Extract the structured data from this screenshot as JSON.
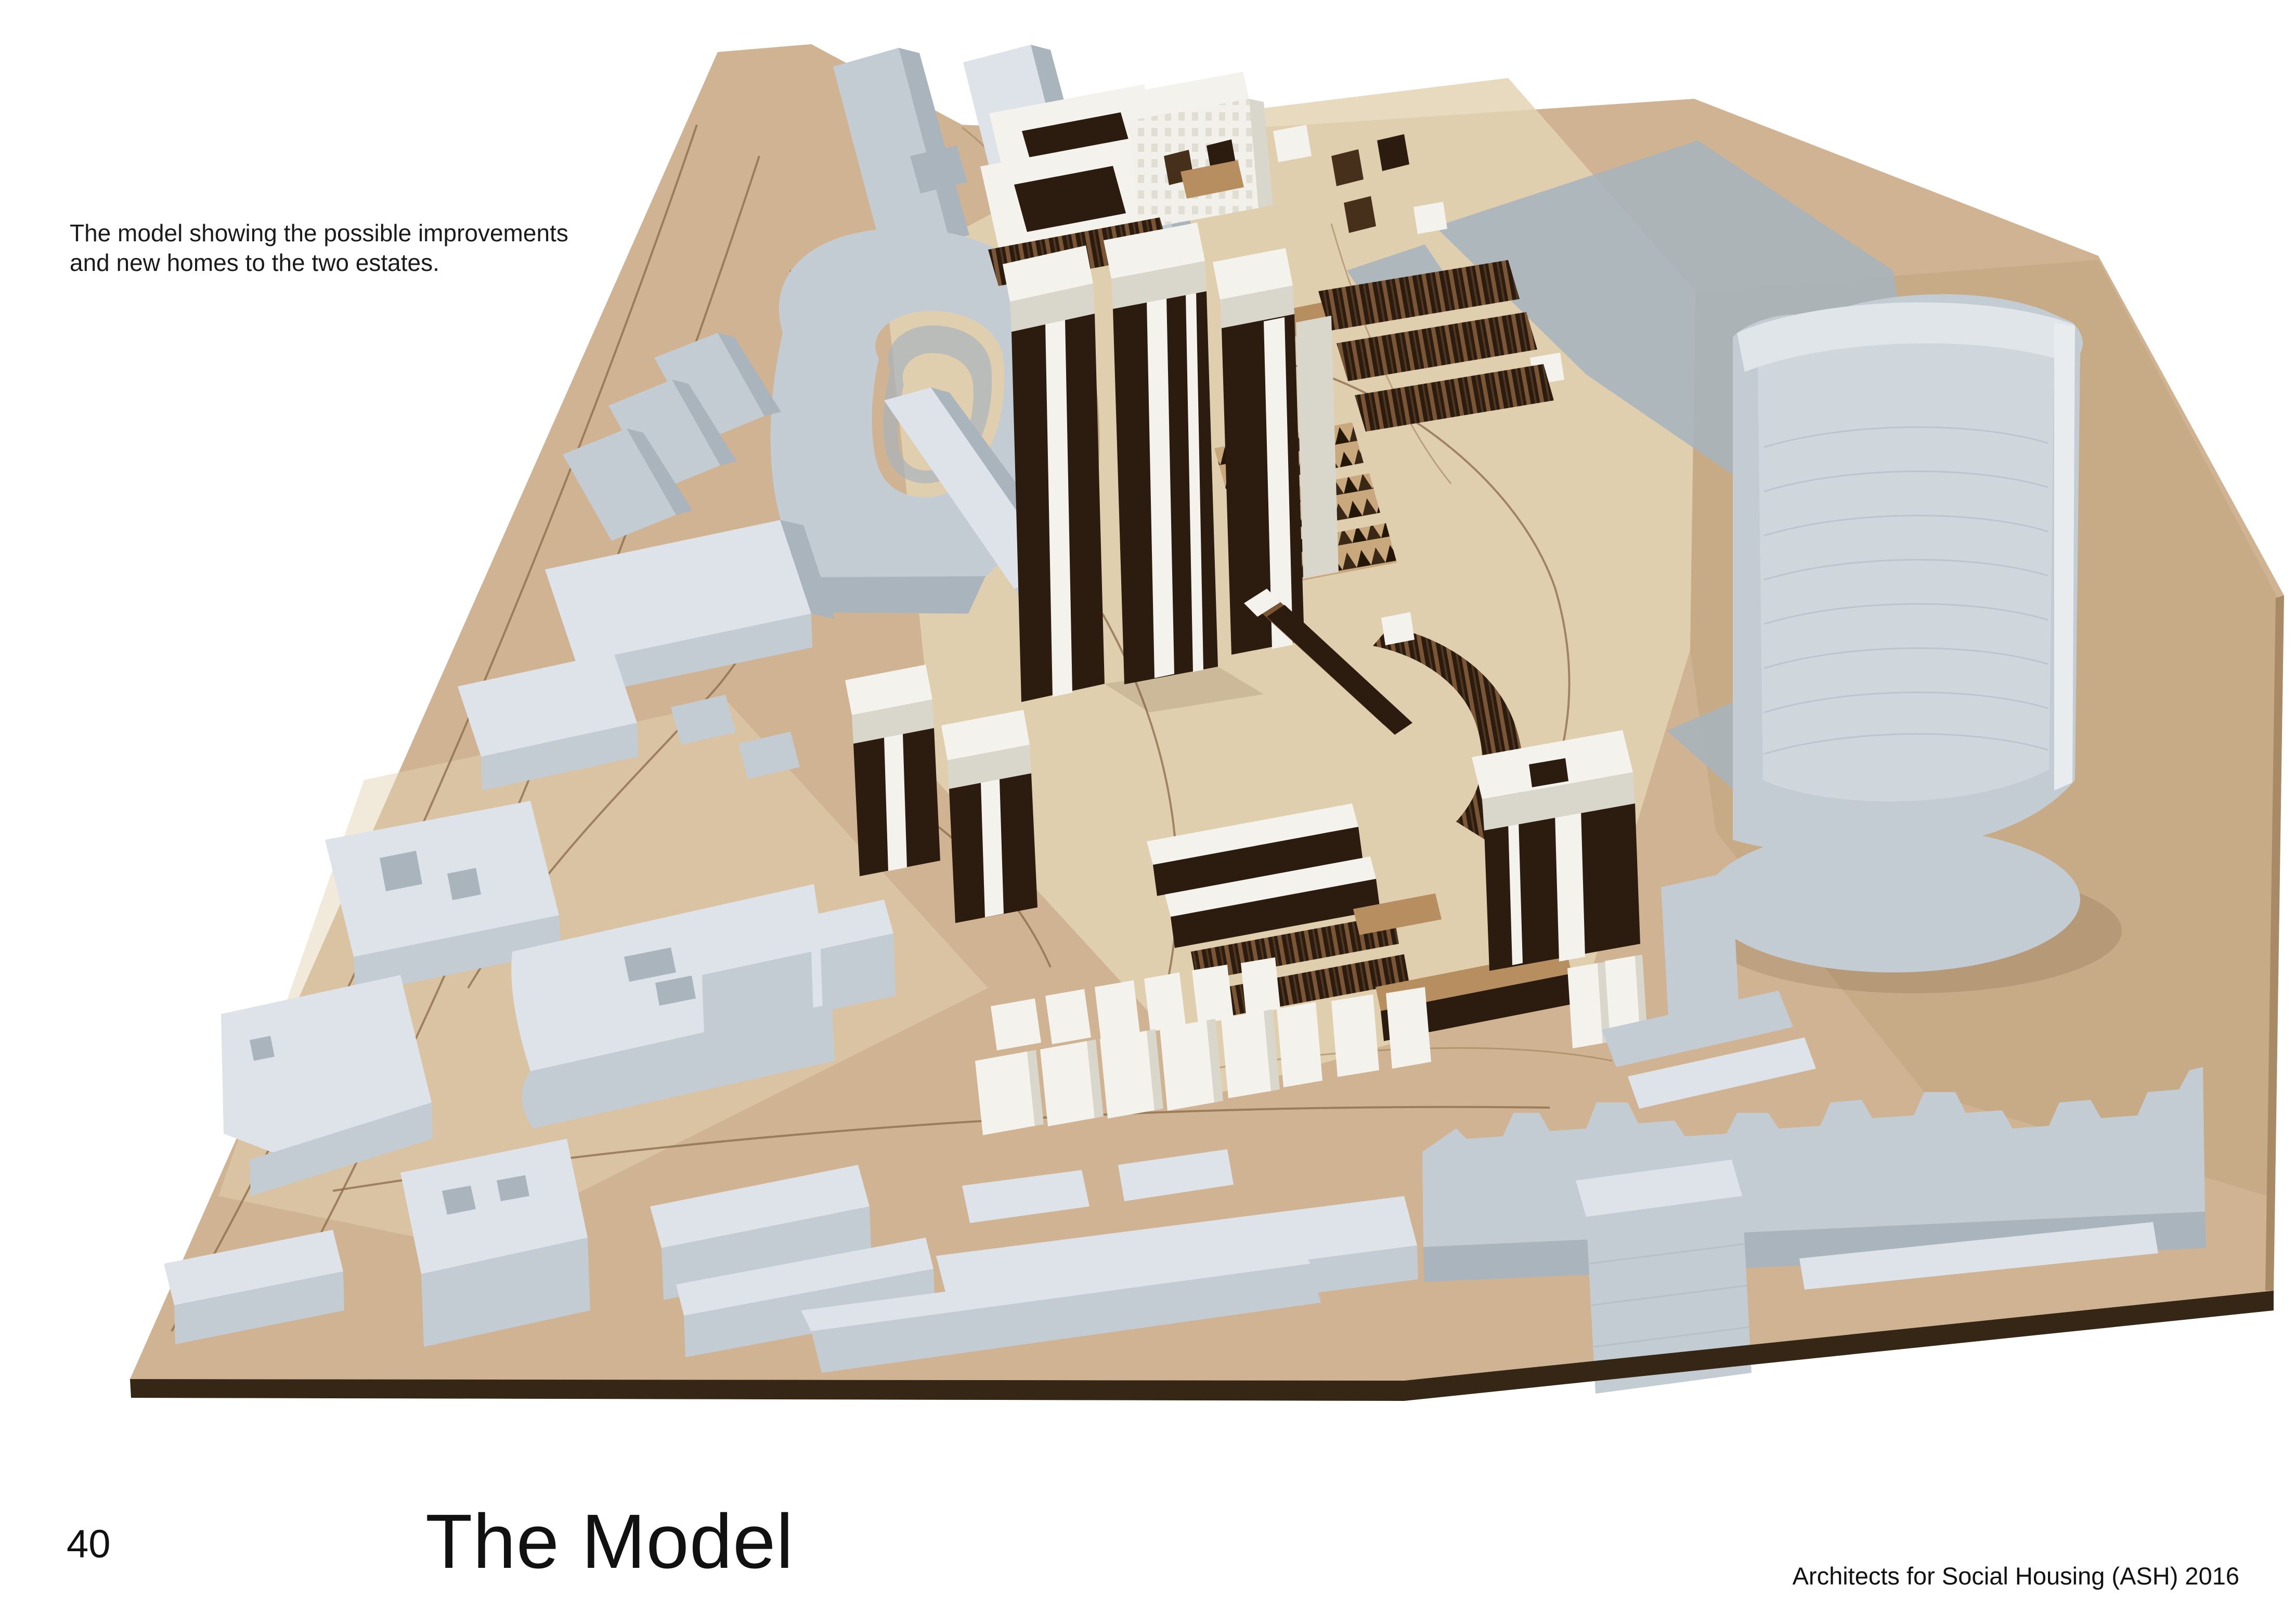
{
  "page": {
    "background": "#ffffff",
    "caption_line1": "The model showing the possible improvements",
    "caption_line2": "and new homes to the two estates.",
    "page_number": "40",
    "title": "The Model",
    "credit": "Architects for Social Housing (ASH) 2016"
  },
  "photo": {
    "kind": "photograph of an architectural site model on a plywood baseboard",
    "etched_street_label": "Thaxton Rd",
    "elements": [
      "plywood-baseboard",
      "gray-context-buildings",
      "crescent-block",
      "white-capped-charred-towers",
      "charred-timber-terraces",
      "timber-houses",
      "white-estate-courts",
      "new-white-housing-cluster",
      "curved-cylinder-tower",
      "flat-gray-plates",
      "street-skyline-strip"
    ],
    "palette": {
      "board_wood": "#cfb392",
      "board_wood_light": "#e3d3b3",
      "board_wood_dark": "#c2a37f",
      "board_edge": "#352616",
      "context_gray": "#c3ccd3",
      "context_gray_light": "#dde3e8",
      "context_gray_dark": "#a9b4bd",
      "estate_white": "#f4f2ec",
      "estate_white_shadow": "#d9d6cc",
      "charred_dark": "#2c1c10",
      "charred_mid": "#46301c",
      "timber_light": "#b78e5f",
      "road_line": "#8a6a48"
    }
  }
}
